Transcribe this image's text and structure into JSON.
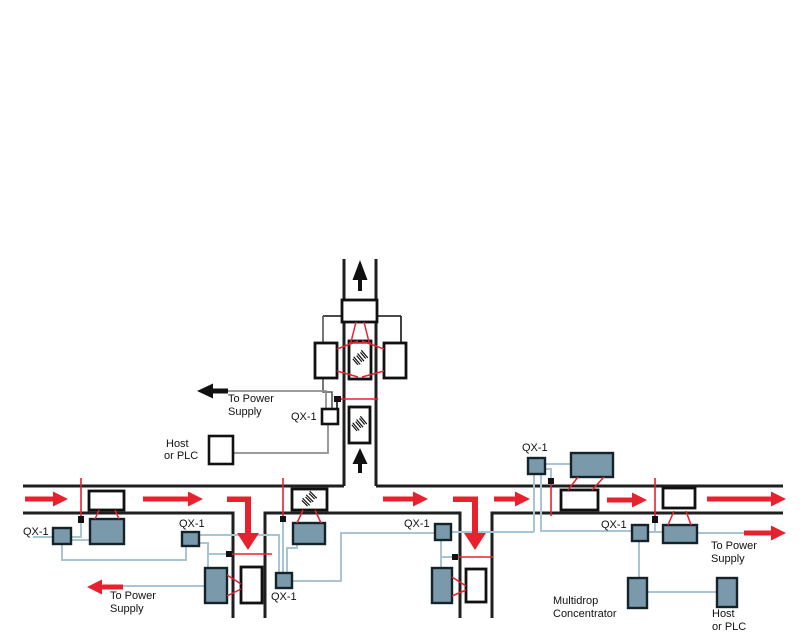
{
  "diagram_title": "Multidrop conveyor scanning network with QX-1 interconnects",
  "labels": {
    "qx1": "QX-1",
    "to_power": "To Power",
    "supply": "Supply",
    "host": "Host",
    "or_plc": "or PLC",
    "multidrop": "Multidrop",
    "concentrator": "Concentrator"
  },
  "components": {
    "device_box": "QX-1 interconnect",
    "scanner_box": "barcode scanner",
    "package_box": "package on conveyor",
    "sensor_square": "object-detect photo sensor",
    "beam_line": "sensor trigger beam",
    "scan_line": "scanner read beam",
    "cable_line": "interconnect cable",
    "conveyor_line": "conveyor edge",
    "arrow": "conveyor travel direction"
  },
  "colors": {
    "device_fill": "#7a9aab",
    "device_border": "#14222a",
    "cable_blue": "#a9c4d3",
    "cable_gray": "#8f8f8f",
    "beam_red": "#e8212e",
    "conveyor_black": "#1f1f1f",
    "background": "#ffffff"
  }
}
